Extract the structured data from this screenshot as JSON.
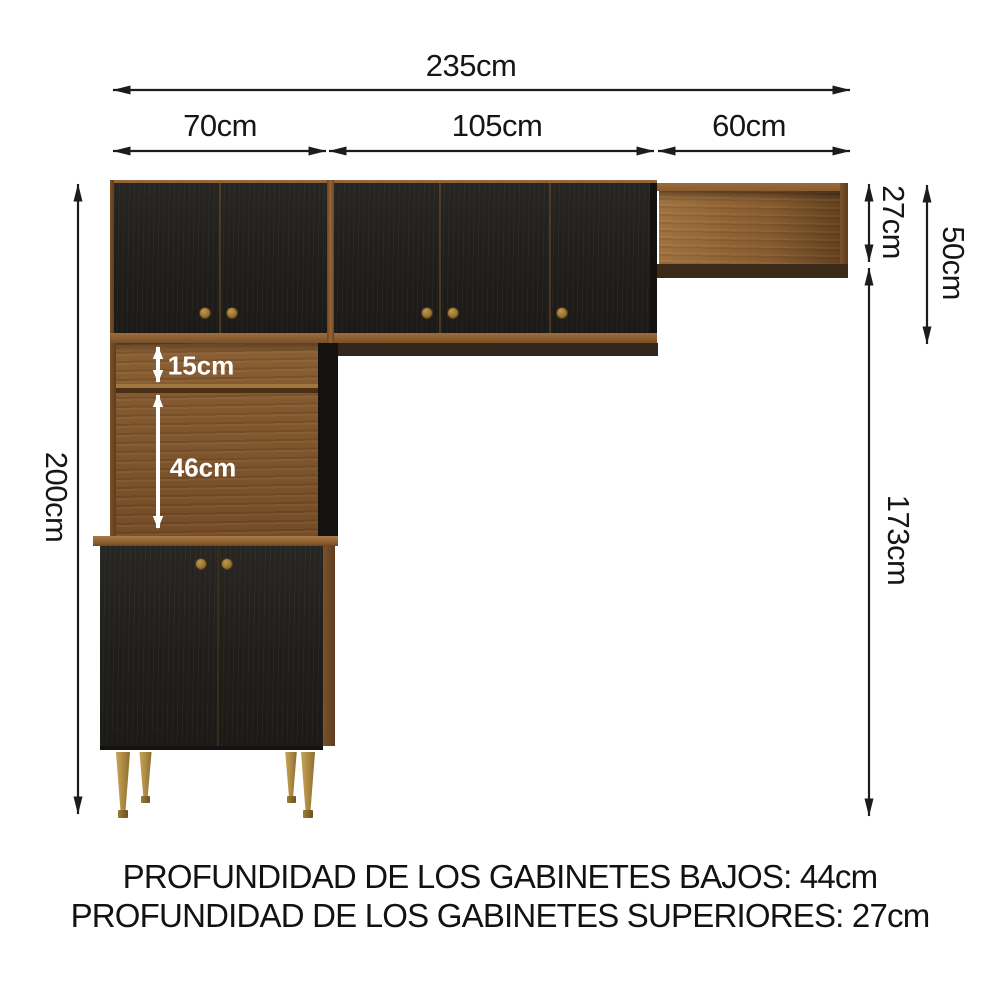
{
  "dimensions": {
    "total_width": "235cm",
    "left_unit_width": "70cm",
    "center_unit_width": "105cm",
    "right_unit_width": "60cm",
    "total_height": "200cm",
    "wall_shelf_height": "27cm",
    "upper_cabinet_height": "50cm",
    "below_shelf_height": "173cm",
    "niche_top_height": "15cm",
    "niche_bottom_height": "46cm"
  },
  "footer": {
    "line1": "PROFUNDIDAD DE LOS GABINETES BAJOS: 44cm",
    "line2": "PROFUNDIDAD DE LOS GABINETES SUPERIORES: 27cm"
  },
  "colors": {
    "background": "#ffffff",
    "dimension": "#1c1c1c",
    "door_black": "#201e1b",
    "wood_medium": "#8a5c32",
    "soffit_dark": "#33261a",
    "brass_knob": "#8f6c2c",
    "leg_gold_light": "#d3b269",
    "leg_gold_dark": "#7c5d26",
    "white_label": "#ffffff"
  }
}
